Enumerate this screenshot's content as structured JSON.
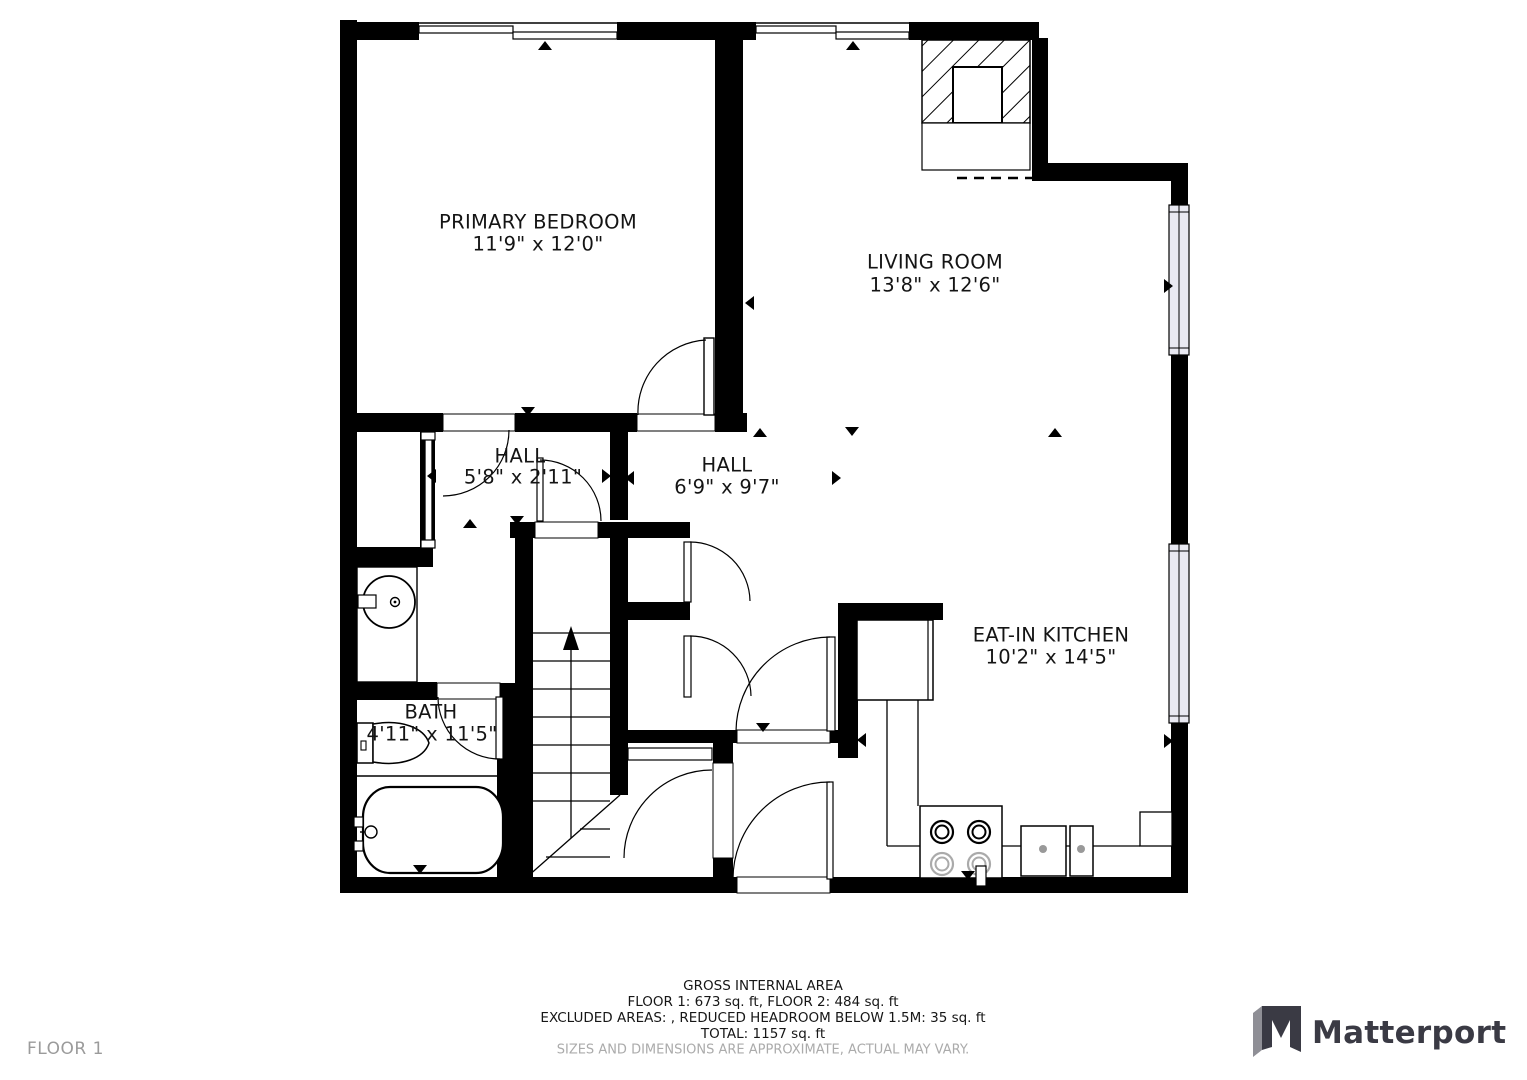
{
  "plan": {
    "rooms": [
      {
        "name": "PRIMARY BEDROOM",
        "dims": "11'9\" x 12'0\""
      },
      {
        "name": "LIVING ROOM",
        "dims": "13'8\" x 12'6\""
      },
      {
        "name": "HALL",
        "dims": "5'8\" x 2'11\""
      },
      {
        "name": "HALL",
        "dims": "6'9\" x 9'7\""
      },
      {
        "name": "EAT-IN KITCHEN",
        "dims": "10'2\" x 14'5\""
      },
      {
        "name": "BATH",
        "dims": "4'11\" x 11'5\""
      }
    ]
  },
  "footer": {
    "title": "GROSS INTERNAL AREA",
    "line1": "FLOOR 1: 673 sq. ft, FLOOR 2: 484 sq. ft",
    "line2": "EXCLUDED AREAS: , REDUCED HEADROOM BELOW 1.5M: 35 sq. ft",
    "line3": "TOTAL: 1157 sq. ft",
    "disclaimer": "SIZES AND DIMENSIONS ARE APPROXIMATE, ACTUAL MAY VARY."
  },
  "floor_label": "FLOOR 1",
  "brand": {
    "name": "Matterport"
  },
  "colors": {
    "wall": "#000000",
    "window_fill": "#e9e9f2",
    "muted_text": "#ababab",
    "floor_label_text": "#9b9b9b",
    "brand_text": "#3a3a44"
  }
}
